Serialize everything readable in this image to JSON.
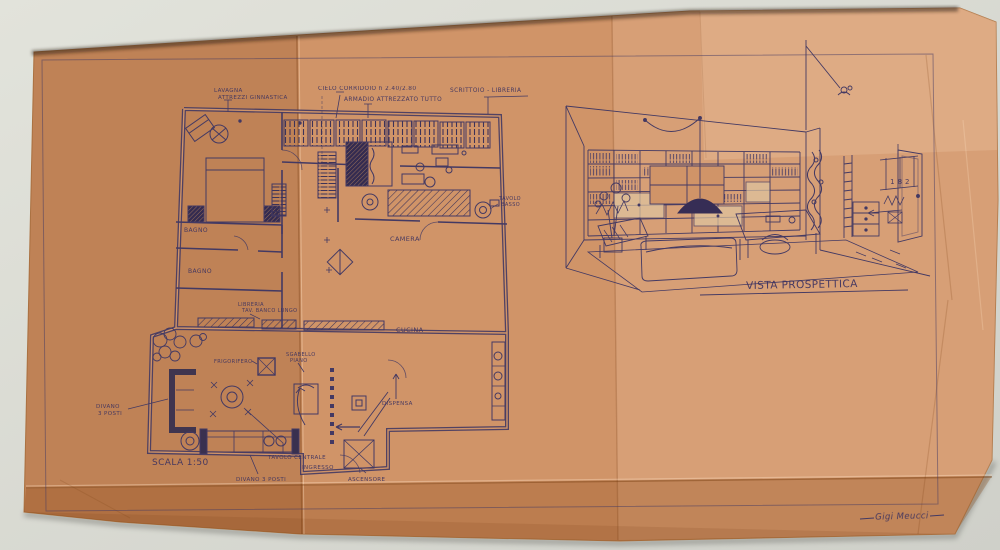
{
  "scene": {
    "background_color": "#d9dad3",
    "paper_color": "#d09468",
    "ink_color": "#433963"
  },
  "plan": {
    "scale_note": "SCALA 1:50",
    "notes": {
      "lavagna_line1": "LAVAGNA",
      "lavagna_line2": "ATTREZZI GINNASTICA",
      "cielo_corridoio": "CIELO CORRIDOIO h 2.40/2.80",
      "armadio": "ARMADIO ATTREZZATO TUTTO",
      "scrittoio": "SCRITTOIO - LIBRERIA"
    },
    "rooms": {
      "bagno1": "BAGNO",
      "bagno2": "BAGNO",
      "camera": "CAMERA",
      "cucina": "CUCINA"
    },
    "furniture": {
      "tavolo_basso_line1": "TAVOLO",
      "tavolo_basso_line2": "BASSO",
      "libreria_line1": "LIBRERIA",
      "libreria_line2": "TAV. BANCO LUNGO",
      "frigorifero": "FRIGORIFERO",
      "sgabello_line1": "SGABELLO",
      "sgabello_line2": "PIANO",
      "divano_line1": "DIVANO",
      "divano_line2": "3 POSTI",
      "tavolo_centrale": "TAVOLO CENTRALE",
      "divano_fondo": "DIVANO 3 POSTI",
      "ingresso": "INGRESSO",
      "ascensore": "ASCENSORE",
      "dispensa": "DISPENSA"
    }
  },
  "perspective": {
    "caption": "VISTA PROSPETTICA",
    "dim_numbers": "1 8 2"
  },
  "signature": "Gigi Meucci"
}
